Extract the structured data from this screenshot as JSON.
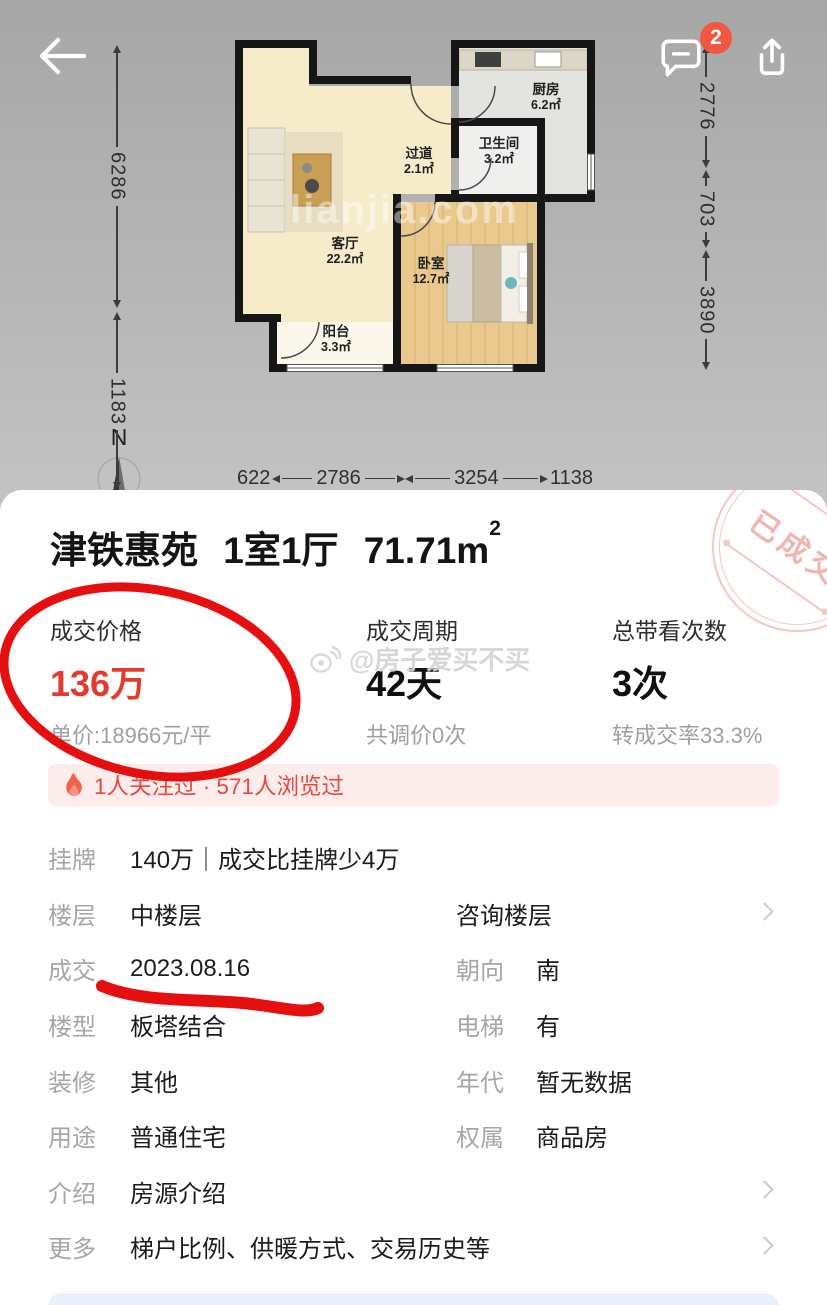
{
  "topbar": {
    "badge": "2"
  },
  "icons": {
    "back": "arrow-left",
    "comment": "speech-bubble-minus",
    "share": "arrow-up-from-box",
    "flame": "flame",
    "compass": "north-needle",
    "chevron": "chevron-right",
    "weibo": "weibo-eye"
  },
  "floorplan": {
    "compass": "N",
    "watermark": "lianjia.com",
    "rooms": [
      {
        "name": "客厅",
        "area": "22.2㎡"
      },
      {
        "name": "卧室",
        "area": "12.7㎡"
      },
      {
        "name": "厨房",
        "area": "6.2㎡"
      },
      {
        "name": "卫生间",
        "area": "3.2㎡"
      },
      {
        "name": "过道",
        "area": "2.1㎡"
      },
      {
        "name": "阳台",
        "area": "3.3㎡"
      }
    ],
    "dims_left": [
      "6286",
      "1183"
    ],
    "dims_right": [
      "2776",
      "703",
      "3890"
    ],
    "dims_bottom": [
      "622",
      "2786",
      "3254",
      "1138"
    ]
  },
  "card": {
    "stamp": "已成交",
    "title": {
      "name": "津铁惠苑",
      "layout": "1室1厅",
      "area": "71.71m",
      "area_sup": "2"
    },
    "watermark": "@房子爱买不买",
    "stats": [
      {
        "label": "成交价格",
        "value": "136万",
        "sub": "单价:18966元/平"
      },
      {
        "label": "成交周期",
        "value": "42天",
        "sub": "共调价0次"
      },
      {
        "label": "总带看次数",
        "value": "3次",
        "sub": "转成交率33.3%"
      }
    ],
    "notice": "1人关注过 · 571人浏览过",
    "rows": [
      {
        "label": "挂牌",
        "value": "140万｜成交比挂牌",
        "value_green": "少4万"
      },
      {
        "label": "楼层",
        "value": "中楼层",
        "link": "咨询楼层"
      },
      {
        "label": "成交",
        "value": "2023.08.16",
        "label2": "朝向",
        "value2": "南"
      },
      {
        "label": "楼型",
        "value": "板塔结合",
        "label2": "电梯",
        "value2": "有"
      },
      {
        "label": "装修",
        "value": "其他",
        "label2": "年代",
        "value2": "暂无数据"
      },
      {
        "label": "用途",
        "value": "普通住宅",
        "label2": "权属",
        "value2": "商品房"
      },
      {
        "label": "介绍",
        "value": "房源介绍"
      },
      {
        "label": "更多",
        "value": "梯户比例、供暖方式、交易历史等"
      }
    ]
  },
  "colors": {
    "price_red": "#e23a2c",
    "doodle_red": "#e60f0f",
    "green": "#21a45d",
    "link_blue": "#3476f5",
    "notice_red": "#e5493f",
    "notice_bg": "#fcecec",
    "badge_red": "#f25742"
  }
}
